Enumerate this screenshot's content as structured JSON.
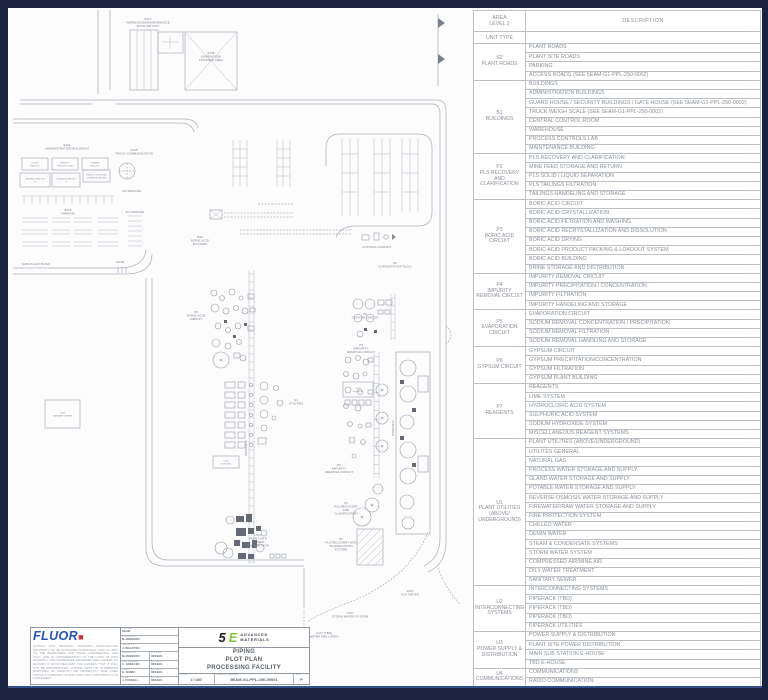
{
  "table": {
    "header": {
      "area1": "AREA",
      "area2": "LEVEL 2",
      "unit_type": "UNIT TYPE",
      "description": "DESCRIPTION"
    },
    "groups": [
      {
        "code": "S2",
        "name": "PLANT ROADS",
        "rows": [
          "PLANT ROADS",
          "PLANT SITE ROADS",
          "PARKING",
          "ACCESS ROADS (SEE 5EAM-G1-PPL-250-0002)"
        ]
      },
      {
        "code": "B1",
        "name": "BUILDINGS",
        "rows": [
          "BUILDINGS",
          "ADMINISTRATION BUILDINGS",
          "GUARD HOUSE / SECURITY BUILDINGS / GATE HOUSE (SEE 5EAM-G1-PPL-250-0002)",
          "TRUCK WEIGH SCALE (SEE 5EAM-G1-PPL-250-0002)",
          "CENTRAL CONTROL ROOM",
          "WAREHOUSE",
          "PROCESS CONTROLS LAB",
          "MAINTENANCE BUILDING"
        ]
      },
      {
        "code": "P2",
        "name": "PLS RECOVERY AND CLARIFICATION",
        "rows": [
          "PLS RECOVERY AND CLARIFICATION",
          "MINE FEED STORAGE AND RETURN",
          "PLS SOLID / LIQUID SEPARATION",
          "PLS TAILINGS FILTRATION",
          "TAILINGS HANDELING AND STORAGE"
        ]
      },
      {
        "code": "P3",
        "name": "BORIC ACID CIRCUIT",
        "rows": [
          "BORIC ACID CIRCUIT",
          "BORIC ACID CRYSTALLIZATION",
          "BORIC ACID FILTRATION AND WASHING",
          "BORIC ACID RECRYSTALLIZATION AND DISSOLUTION",
          "BORIC ACID DRYING",
          "BORIC ACID PRODUCT PACKING & LOADOUT SYSTEM",
          "BORIC ACID BUILDING",
          "BRINE STORAGE AND DISTRIBUTION"
        ]
      },
      {
        "code": "P4",
        "name": "IMPURITY REMOVAL CIRCUIT",
        "rows": [
          "IMPURITY REMOVAL CIRCUIT",
          "IMPURITY PRECIPITATION / CONCENTRATION",
          "IMPURITY FILTRATION",
          "IMPURITY HANDELING AND STORAGE"
        ]
      },
      {
        "code": "P5",
        "name": "EVAPORATION CIRCUIT",
        "rows": [
          "EVAPORATION CIRCUIT",
          "SODIUM REMOVAL CONCENTRATION / PRECIPITATION",
          "SODIUM REMOVAL FILTRATION",
          "SODIUM REMOVAL HANDLING AND STORAGE"
        ]
      },
      {
        "code": "P6",
        "name": "GYPSUM CIRCUIT",
        "rows": [
          "GYPSUM CIRCUIT",
          "GYPSUM PRECIPITATION/CONCENTRATION",
          "GYPSUM FILTRATION",
          "GYPSUM PLANT BUILDING"
        ]
      },
      {
        "code": "P7",
        "name": "REAGENTS",
        "rows": [
          "REAGENTS",
          "LIME SYSTEM",
          "HYDROCLORIC ACID SYSTEM",
          "SULPHURIC ACID SYSTEM",
          "SODIUM HYDROXIDE SYSTEM",
          "MISCELLANEOUS REAGENT SYSTEMS"
        ]
      },
      {
        "code": "U1",
        "name": "PLANT UTILITIES (ABOVE/ UNDERGROUND)",
        "rows": [
          "PLANT UTILITIES (ABOVE/UNDERGROUND)",
          "UTILITES GENERAL",
          "NATURAL GAS",
          "PROCESS WATER STORAGE AND SUPPLY",
          "GLAND WATER STORAGE AND SUPPLY",
          "POTABLE WATER STORAGE AND SUPPLY",
          "REVERSE OSMOSIS WATER STORAGE AND SUPPLY",
          "FIREWATER/RAW WATER STORAGE AND SUPPLY",
          "FIRE PROTECTION SYSTEM",
          "CHILLED WATER",
          "DEMIN WATER",
          "STEAM & CONDENSATE SYSTEMS",
          "STORM WATER SYSTEM",
          "COMPRESSED AIR/MINE AIR",
          "OILY WATER TREATMENT",
          "SANITARY SEWER"
        ]
      },
      {
        "code": "U2",
        "name": "INTERCONNECTING SYSTEMS",
        "rows": [
          "INTERCONNECTING SYSTEMS",
          "PIPERACK (TBD)",
          "PIPERACK (TBD)",
          "PIPERACK (TBD)",
          "PIPERACK UTILITIES"
        ]
      },
      {
        "code": "U3",
        "name": "POWER SUPPLY & DISTRIBUTION",
        "rows": [
          "POWER SUPPLY & DISTRIBUTION",
          "PLANT SITE POWER DISTRIBUTION",
          "MAIN SUB STATION E-HOUSE",
          "TBD E-HOUSE"
        ]
      },
      {
        "code": "U4",
        "name": "COMMUNICATIONS",
        "rows": [
          "COMMUNICATIONS",
          "RADIO COMMUNICATION"
        ]
      }
    ]
  },
  "drawing": {
    "labels": [
      {
        "x": 140,
        "y": 12,
        "ls": [
          "8107",
          "WAREHOUSE/MAINTENANCE",
          "BLDG 150'X110'"
        ]
      },
      {
        "x": 203,
        "y": 46,
        "ls": [
          "8108",
          "WAREHOUSE",
          "LAYDOWN AREA"
        ]
      },
      {
        "x": 59,
        "y": 138,
        "ls": [
          "8101",
          "ADMINISTRATION BUILDINGS"
        ]
      },
      {
        "x": 126,
        "y": 143,
        "ls": [
          "8105",
          "TRUCK COMMUNICATION"
        ]
      },
      {
        "x": 124,
        "y": 184,
        "ls": [
          "EV PARKING"
        ]
      },
      {
        "x": 60,
        "y": 203,
        "ls": [
          "8201",
          "PARKING"
        ]
      },
      {
        "x": 127,
        "y": 205,
        "ls": [
          "EV PARKING"
        ]
      },
      {
        "x": 28,
        "y": 257,
        "ls": [
          "S201 PLANT ROAD"
        ]
      },
      {
        "x": 112,
        "y": 255,
        "ls": [
          "GATE"
        ]
      },
      {
        "x": 369,
        "y": 240,
        "ls": [
          "GYPSUM LOADOUT"
        ]
      },
      {
        "x": 387,
        "y": 256,
        "ls": [
          "P6",
          "GYPSUM PLANT BLDG"
        ]
      },
      {
        "x": 192,
        "y": 230,
        "ls": [
          "P3A",
          "BORIC ACID",
          "BUILDING"
        ]
      },
      {
        "x": 188,
        "y": 305,
        "ls": [
          "P3",
          "BORIC ACID",
          "CIRCUIT"
        ]
      },
      {
        "x": 357,
        "y": 307,
        "ls": [
          "P6",
          "GYPSUM CIRCUIT"
        ]
      },
      {
        "x": 353,
        "y": 338,
        "ls": [
          "P4",
          "IMPURITY",
          "REMOVAL CIRCUIT"
        ]
      },
      {
        "x": 288,
        "y": 393,
        "ls": [
          "U1",
          "UTILITIES"
        ]
      },
      {
        "x": 331,
        "y": 458,
        "ls": [
          "P4",
          "IMPURITY",
          "REMOVAL CIRCUIT"
        ]
      },
      {
        "x": 338,
        "y": 496,
        "ls": [
          "P2",
          "PLS RECOVERY",
          "AND",
          "CLARIFICATION"
        ]
      },
      {
        "x": 333,
        "y": 532,
        "ls": [
          "P2",
          "PLS RECOVERY AND",
          "CLARIFICATION",
          "FUTURE"
        ]
      },
      {
        "x": 250,
        "y": 528,
        "ls": [
          "U307",
          "PLANT SITE",
          "POWER",
          "DISTRIBUTION"
        ]
      },
      {
        "x": 342,
        "y": 606,
        "ls": [
          "U107",
          "STORM WATER SYSTEM"
        ]
      },
      {
        "x": 402,
        "y": 584,
        "ls": [
          "2021",
          "H2O METER"
        ]
      },
      {
        "x": 316,
        "y": 626,
        "ls": [
          "U117 (TBD)",
          "WATER WELL AREA"
        ]
      },
      {
        "x": 239,
        "y": 440,
        "rot": -90,
        "ls": [
          "PIPERACK"
        ]
      },
      {
        "x": 386,
        "y": 420,
        "rot": -90,
        "ls": [
          "PIPERACK"
        ]
      }
    ],
    "boxes": [
      {
        "x": 14,
        "y": 150,
        "w": 26,
        "h": 12,
        "ls": [
          "LUNCH",
          "FACILITY"
        ]
      },
      {
        "x": 44,
        "y": 150,
        "w": 26,
        "h": 12,
        "ls": [
          "FACILITY",
          "PROCESS LAB"
        ]
      },
      {
        "x": 74,
        "y": 150,
        "w": 26,
        "h": 12,
        "ls": [
          "CHANGE",
          "FACILITY"
        ]
      },
      {
        "x": 12,
        "y": 165,
        "w": 30,
        "h": 14,
        "ls": [
          "ADMINISTRATION",
          "A"
        ]
      },
      {
        "x": 44,
        "y": 165,
        "w": 28,
        "h": 14,
        "ls": [
          "ADMINISTRATION",
          "B"
        ]
      },
      {
        "x": 75,
        "y": 162,
        "w": 27,
        "h": 12,
        "ls": [
          "FACILITY FIRST AID",
          "COMMUNICATIONS"
        ]
      },
      {
        "x": 37,
        "y": 392,
        "w": 35,
        "h": 28,
        "ls": [
          "U116",
          "SANITARY SEWER"
        ]
      },
      {
        "x": 335,
        "y": 374,
        "w": 30,
        "h": 15,
        "ls": [
          "U301",
          "E-HOUSE"
        ]
      },
      {
        "x": 205,
        "y": 448,
        "w": 26,
        "h": 12,
        "ls": [
          "U105",
          "E-HOUSE"
        ]
      }
    ]
  },
  "titleblock": {
    "fluor": "FLUOR",
    "notice": "NOTICE: THIS DRAWING CONTAINS INTELLECTUAL PROPERTY OF 5E ADVANCED MATERIALS, AND IS LENT TO THE BORROWER FOR THEIR CONFIDENTIAL USE ONLY, AND IN CONSIDERATION OF THE LOAN OF THIS DRAWING, THE BORROWER PROMISES AND AGREES TO RETURN IT UPON REQUEST AND AGREES THAT IT WILL NOT BE REPRODUCED, COPIED, LENT OR OTHERWISE DISPOSED OF DIRECTLY OR INDIRECTLY, NOR USED FOR ANY PURPOSE OTHER THAN THAT FOR WHICH IT IS FURNISHED.",
    "approvals": [
      {
        "label": "CONTRACT",
        "value": "5EAM"
      },
      {
        "label": "DESIGNED BY",
        "value": "M.JOHNSON"
      },
      {
        "label": "CHECKED BY",
        "value": "J. WALDYKE"
      },
      {
        "label": "SUPERVISOR",
        "value": "M.JOHNSON",
        "date_label": "APP DATE",
        "date": "06/19/24"
      },
      {
        "label": "LEAD ENGINEER",
        "value": "C. ANGELES",
        "date_label": "APP DATE",
        "date": "06/19/24"
      },
      {
        "label": "FLUOR",
        "value": "K. NAMM",
        "date_label": "APP DATE",
        "date": "06/19/24"
      },
      {
        "label": "CLIENT",
        "value": "J. FUSSELL",
        "date_label": "APP DATE",
        "date": "06/19/24"
      }
    ],
    "logo5e": {
      "five": "5",
      "slash_e": "E",
      "line1": "ADVANCED",
      "line2": "MATERIALS"
    },
    "title1": "PIPING",
    "title2": "PLOT PLAN",
    "title3": "PROCESSING FACILITY",
    "scale_label": "SCALE",
    "scale": "1\"=60'",
    "dwg_label": "DRAWING NUMBER",
    "dwg_no": "5EAM-G1-PPL-250-00001",
    "rev_label": "REV",
    "rev": "P"
  }
}
